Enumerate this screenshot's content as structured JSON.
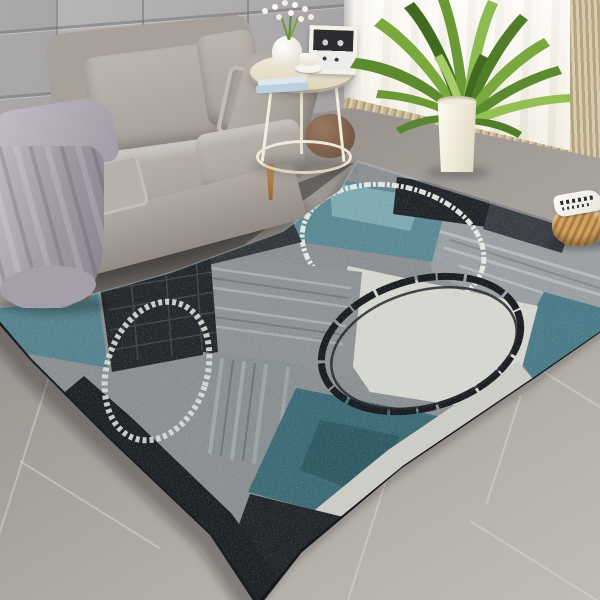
{
  "scene": {
    "description": "Bright modern living room: gray fabric loveseat with throw blanket, round white side table with decor, tall green plant in white floor vase, sheer curtains over a window, rattan basket, and a large abstract patchwork area rug in teal, gray, black and ivory with distressed circle motifs, laid on gray concrete tile floor",
    "objects": {
      "wall": "Gray panelled wall",
      "curtain": "Sheer white curtains with tan fringe hem",
      "side_curtain": "Tan side curtain panel",
      "floor": "Gray concrete tile floor",
      "sofa": "Gray fabric loveseat on wooden legs",
      "blanket": "Gray throw blanket draped over sofa arm",
      "pillow": "Gray accent pillow",
      "side_table": "Round cream side table with lower shelf",
      "books": "Stack of light blue books",
      "table_vase": "Small white vase with white flowers",
      "photo_frame": "Black and white framed print",
      "cup": "White coffee cup and saucer",
      "pouf": "Brown round pouf under side table",
      "plant": "Green blade-leaf plant",
      "floor_vase": "Tall white cylindrical floor vase",
      "basket": "Woven rattan basket with white patterned cloth",
      "rug": "Abstract patchwork area rug with distressed circles"
    },
    "palette": {
      "wall_gray": "#aba9ab",
      "curtain_ivory": "#f6f2e7",
      "fringe_tan": "#c6b592",
      "floor_light": "#b7b1ab",
      "floor_dark": "#8f8a86",
      "sofa_fabric": "#b1aaa3",
      "blanket_gray": "#a39daa",
      "wood_leg": "#a9753e",
      "table_cream": "#ece4d1",
      "pouf_brown": "#83644e",
      "plant_green": "#6b9a34",
      "basket_tan": "#c09059",
      "rug_teal": "#55828e",
      "rug_aqua": "#93bdc2",
      "rug_dark_teal": "#3d6c76",
      "rug_black": "#22252a",
      "rug_gray": "#9aa0a3",
      "rug_ivory": "#d6d7d0",
      "ring_white": "#eaece6",
      "ring_black": "#1a1d22"
    }
  }
}
